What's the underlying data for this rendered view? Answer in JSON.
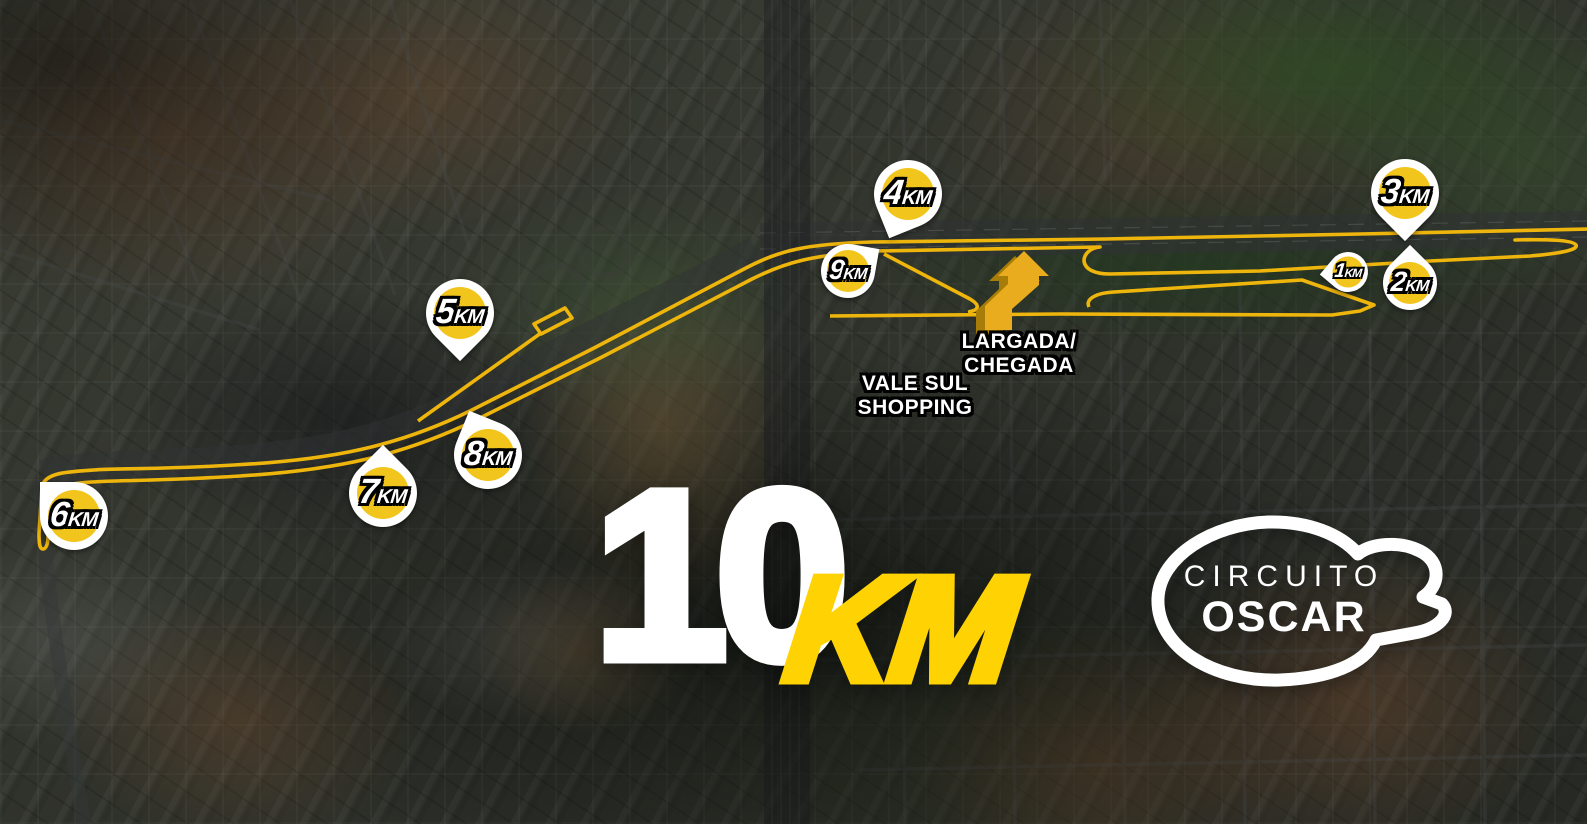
{
  "title": {
    "big": "10",
    "unit": "KM"
  },
  "logo": {
    "line1": "CIRCUITO",
    "line2": "OSCAR"
  },
  "start_finish": {
    "line1": "LARGADA/",
    "line2": "CHEGADA"
  },
  "landmark": {
    "line1": "VALE SUL",
    "line2": "SHOPPING"
  },
  "markers": [
    {
      "id": "km-1",
      "num": "1",
      "unit": "KM"
    },
    {
      "id": "km-2",
      "num": "2",
      "unit": "KM"
    },
    {
      "id": "km-3",
      "num": "3",
      "unit": "KM"
    },
    {
      "id": "km-4",
      "num": "4",
      "unit": "KM"
    },
    {
      "id": "km-5",
      "num": "5",
      "unit": "KM"
    },
    {
      "id": "km-6",
      "num": "6",
      "unit": "KM"
    },
    {
      "id": "km-7",
      "num": "7",
      "unit": "KM"
    },
    {
      "id": "km-8",
      "num": "8",
      "unit": "KM"
    },
    {
      "id": "km-9",
      "num": "9",
      "unit": "KM"
    }
  ],
  "colors": {
    "route_yellow": "#EEB50C",
    "pin_yellow": "#F2C51D",
    "pin_white": "#FFFFFF",
    "title_white": "#FFFFFF",
    "title_km_yellow": "#FFD204",
    "arrow_gold": "#E8AC1E",
    "arrow_gold_dark": "#A87C08",
    "label_text": "#FFFFFF",
    "label_outline": "#000000"
  }
}
